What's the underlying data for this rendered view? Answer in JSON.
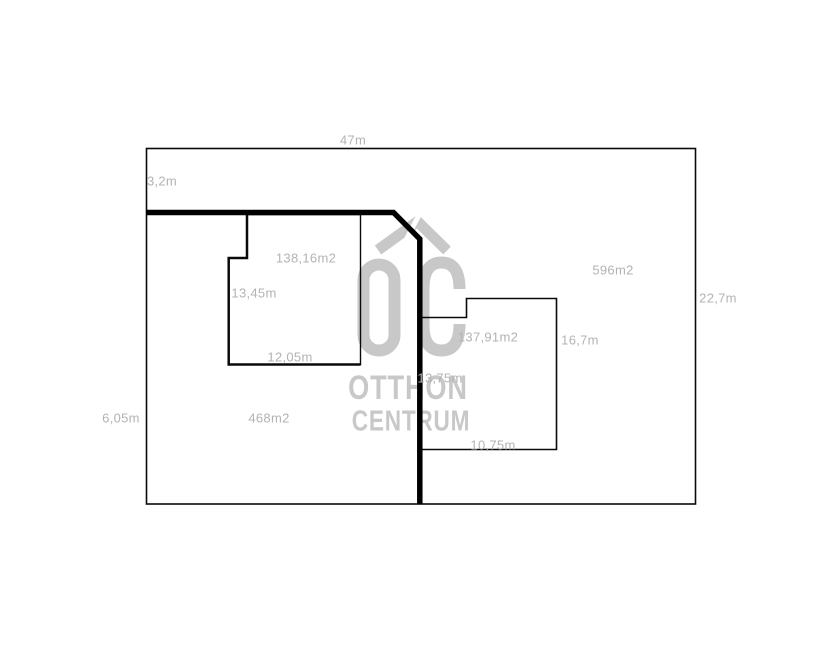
{
  "canvas": {
    "background": "#ffffff"
  },
  "colors": {
    "line_black": "#0a0a0a",
    "label_gray": "#b3b3b3",
    "watermark_gray": "#c8c8c8"
  },
  "plot": {
    "width_label": "47m",
    "top_strip_label": "3,2m",
    "right_side_label": "22,7m",
    "left_side_label": "6,05m",
    "left_area_label": "468m2",
    "right_area_label": "596m2"
  },
  "building_left": {
    "area_label": "138,16m2",
    "height_label": "13,45m",
    "width_label": "12,05m"
  },
  "building_right": {
    "area_label": "137,91m2",
    "right_side_label": "16,7m",
    "left_side_label": "13,75m",
    "width_label": "10,75m"
  },
  "watermark": {
    "initials": "OC",
    "line1": "OTTHON",
    "line2": "CENTRUM"
  }
}
